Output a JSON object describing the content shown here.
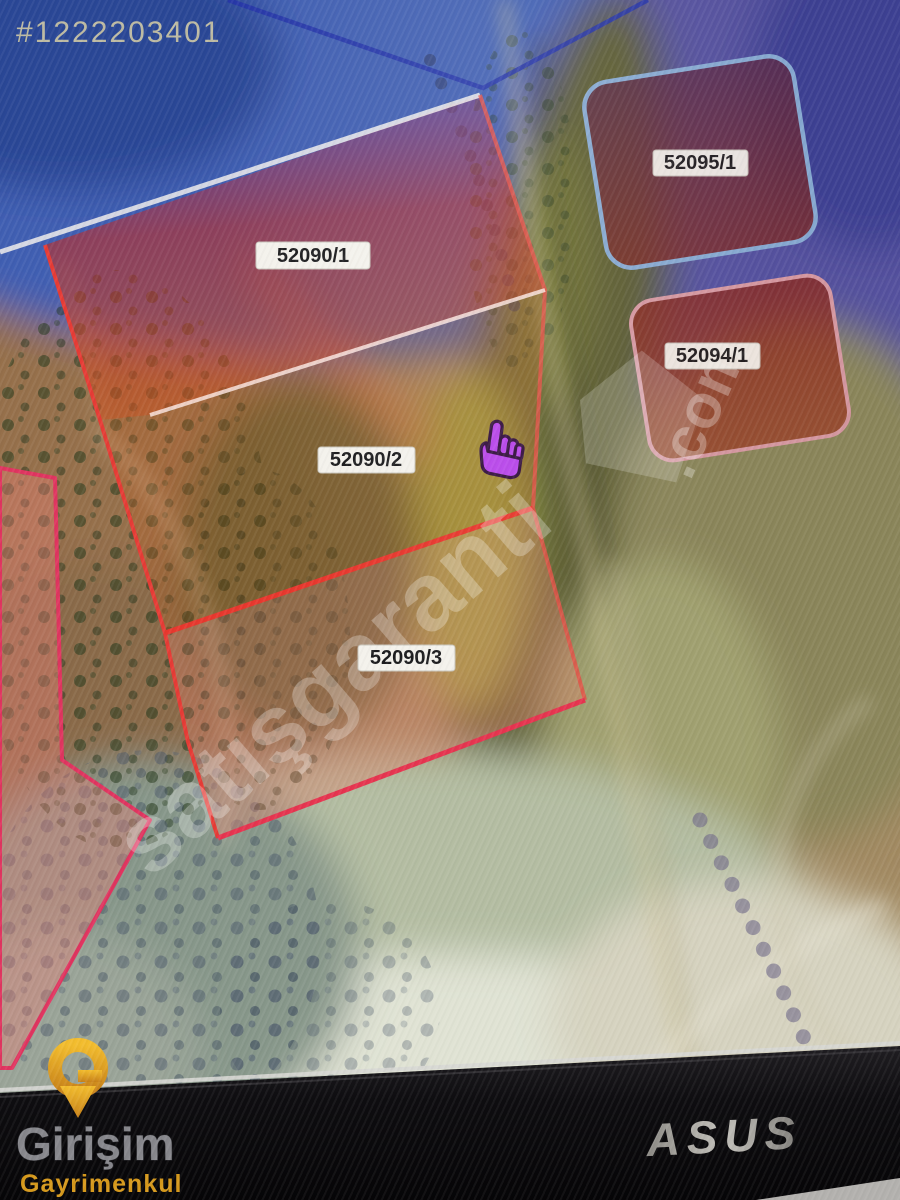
{
  "listing": {
    "id": "#1222203401"
  },
  "map": {
    "parcels": [
      {
        "label": "52090/1"
      },
      {
        "label": "52090/2"
      },
      {
        "label": "52090/3"
      },
      {
        "label": "52095/1"
      },
      {
        "label": "52094/1"
      }
    ],
    "watermark": {
      "text": "satışgaranti",
      "suffix": ".com"
    },
    "cursor": "purple-hand-pointer"
  },
  "monitor": {
    "brand": "ASUS"
  },
  "agency": {
    "mark": "G",
    "name": "Girişim",
    "subtitle": "Gayrimenkul"
  },
  "colors": {
    "overlay_blue": "#3f5fb2",
    "overlay_purple": "#55519e",
    "parcel_red": "#c03028",
    "parcel_pink_line": "#e03560",
    "divider_red": "#e8382e",
    "rounded_parcel_stroke_blue": "#86a8d0",
    "rounded_parcel_stroke_pink": "#d497a0",
    "label_box": "#f4f2ec",
    "gold": "#e8a020",
    "bezel": "#0d0c0e"
  }
}
